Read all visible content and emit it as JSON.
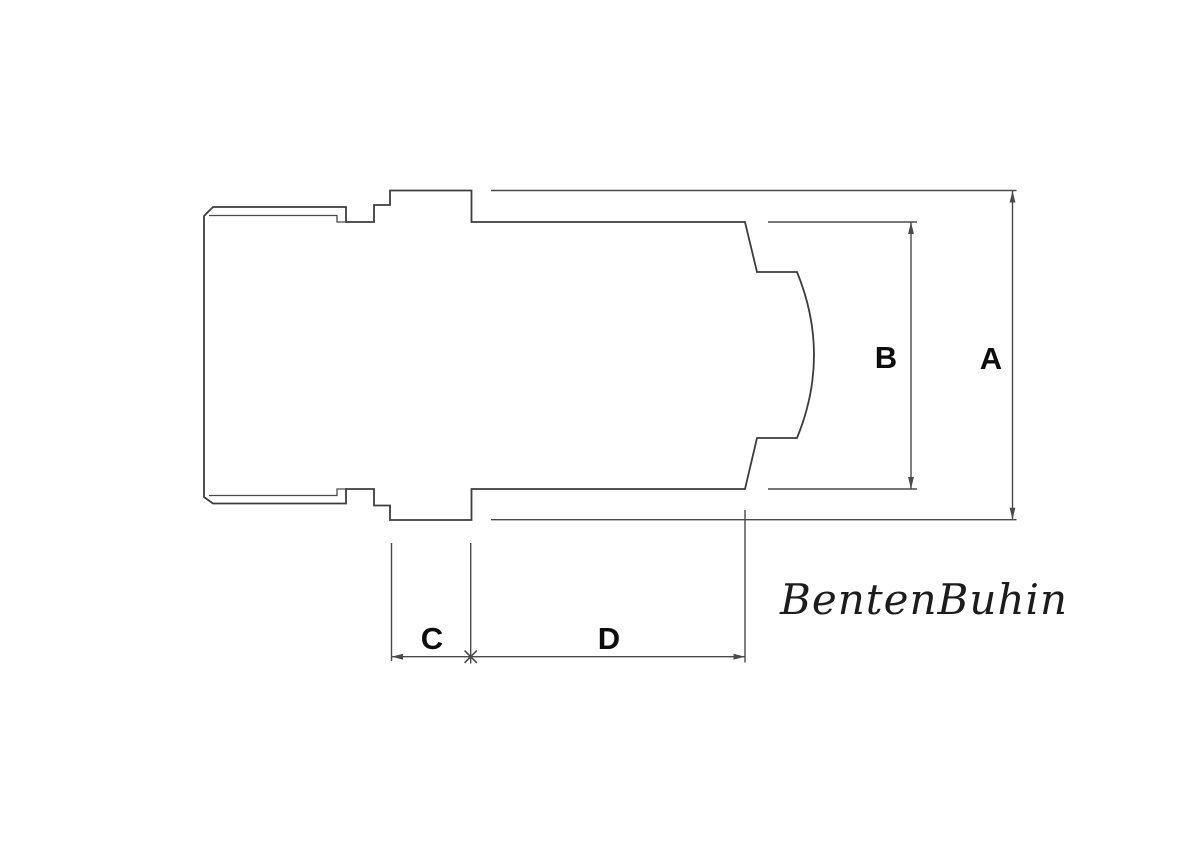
{
  "theme": {
    "bg": "#ffffff",
    "line": "#3d3d3d",
    "thin": "#4a4a4a",
    "label": "#0d0d0d",
    "brand": "#1c1c1c"
  },
  "drawing": {
    "description": "side-view cross-section outline of a machined cap part",
    "part": {
      "outline_path": "M 204 216 L 213 207 L 346 207 L 346 222 L 374 222 L 374 205 L 390 205 L 390 190.5 L 471.5 190.5 L 471.5 222 L 745 222 L 757 272 L 797 272 Q 831 355 797 438 L 757 438 L 745 489 L 471.5 489 L 471.5 520 L 390 520 L 390 505.5 L 374 505.5 L 374 489 L 346 489 L 346 503.5 L 213 503.5 L 204 497 Z",
      "chamfer_edge_path": "M 209 215.5 L 337 215.5 L 337 222 L 346 222 M 209 495.5 L 337 495.5 L 337 489 L 346 489"
    },
    "dimensions": [
      {
        "label": "A",
        "measures": "overall outer diameter across flange",
        "extension_path": "M 491 190.5 H 1016.5 M 491 519.7 H 1016.5",
        "line_path": "M 1012.5 190.5 V 519.7",
        "arrow_path": "M 1012.5 190.5 L 1009.6 202.5 L 1015.4 202.5 Z M 1012.5 519.7 L 1009.6 507.7 L 1015.4 507.7 Z"
      },
      {
        "label": "B",
        "measures": "body outer diameter",
        "extension_path": "M 768 222 H 917 M 768 489 H 917",
        "line_path": "M 911 222 V 489",
        "arrow_path": "M 911 222 L 908.1 234 L 913.9 234 Z M 911 489 L 908.1 477 L 913.9 477 Z"
      },
      {
        "label": "C",
        "measures": "flange width",
        "extension_path": "M 391.5 543 V 661 M 470.7 543 V 663.5",
        "line_path": "M 391.5 656.7 H 470.7",
        "arrow_path": "M 391.5 656.7 L 403 653.8 L 403 659.6 Z"
      },
      {
        "label": "D",
        "measures": "body length",
        "extension_path": "M 745 510 V 662.5",
        "line_path": "M 470.7 656.7 H 745",
        "arrow_path": "M 745 656.7 L 733.5 653.8 L 733.5 659.6 Z",
        "shared_tick_path": "M 464.6 650.6 L 476.8 662.8 M 464.6 662.8 L 476.8 650.6"
      }
    ]
  },
  "labels": {
    "dim_a": "A",
    "dim_b": "B",
    "dim_c": "C",
    "dim_d": "D"
  },
  "brand": {
    "text": "BentenBuhin"
  }
}
